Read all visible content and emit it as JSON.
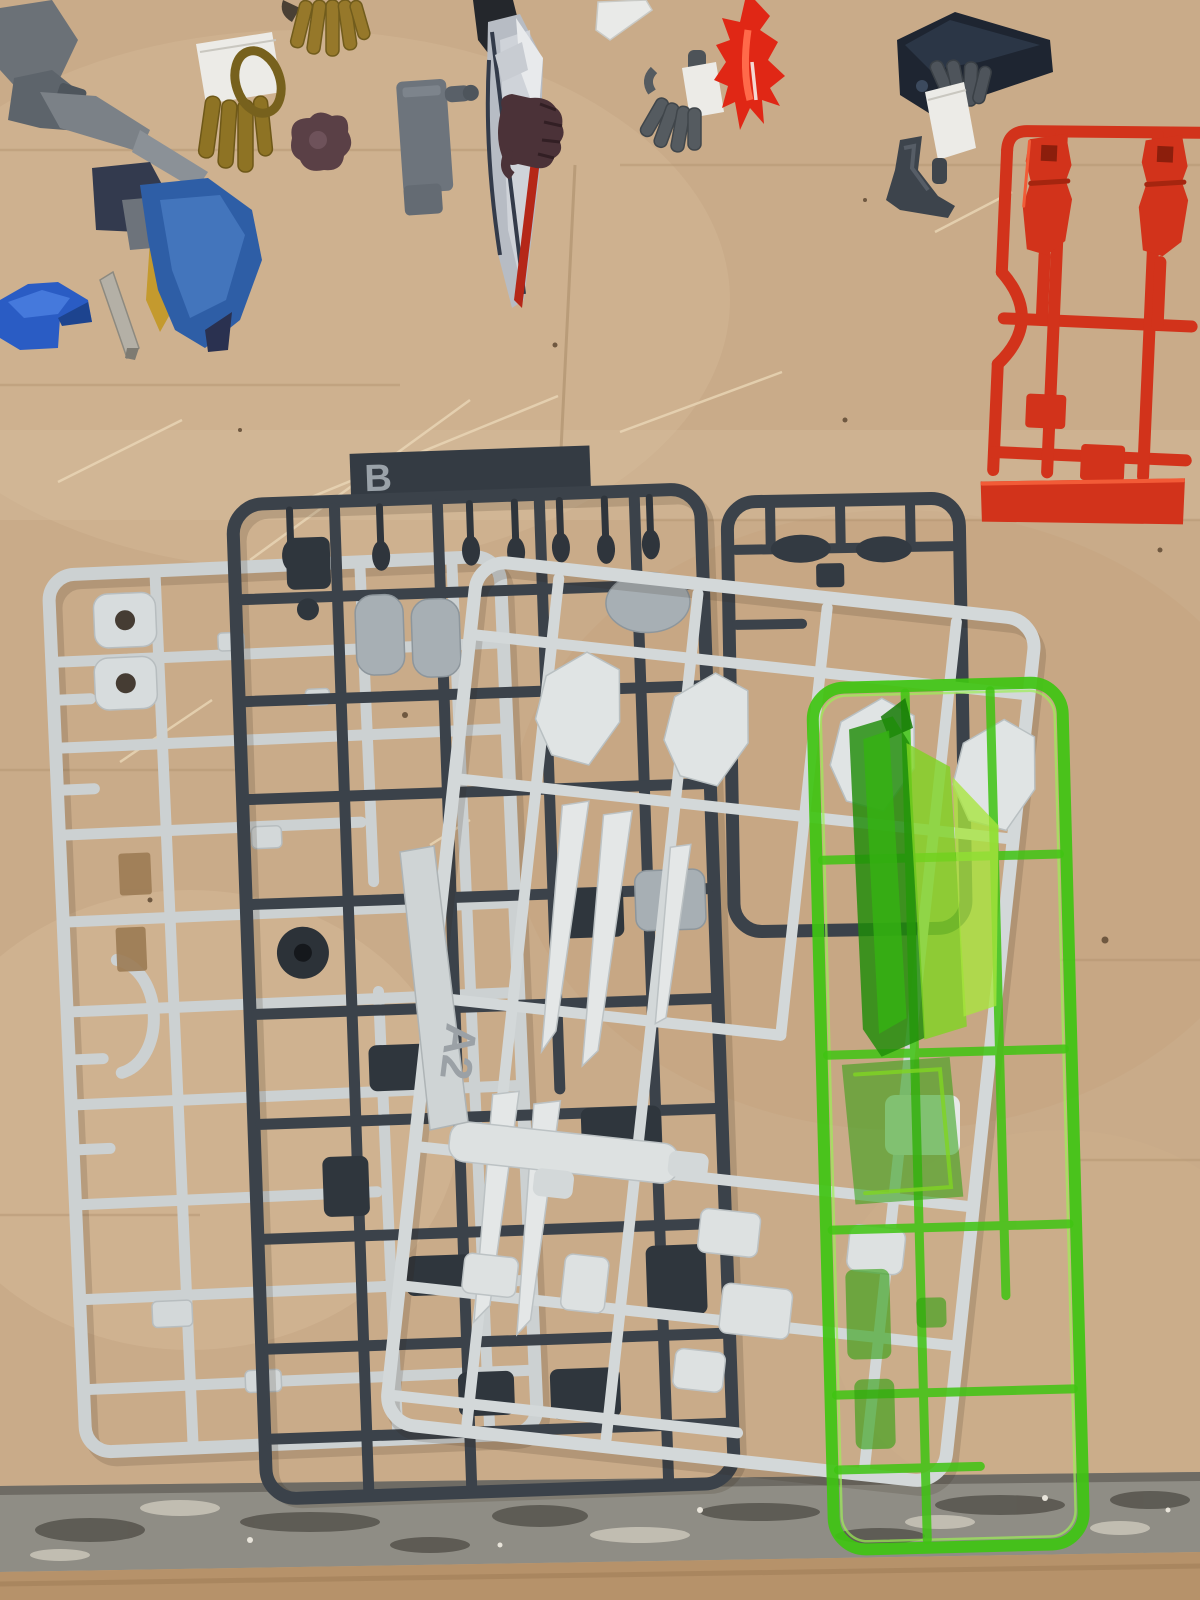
{
  "scene": {
    "description": "Top-down photo of unassembled plastic model-kit (gunpla) runner sprues and loose snipped parts laid out on a light wooden workbench with a worn gray front edge",
    "surface": "light wood desk with scratches, worn metal-gray front edge strip, darker wood below the edge",
    "labels": {
      "sprue_b": "B",
      "sprue_a2": "A2"
    },
    "sprues": [
      {
        "name": "white-left-sprue",
        "label": "",
        "color": "#ccd1d2",
        "description": "light gray runner with round socket knobs, punched-out rectangular gaps and a C-shaped cutout"
      },
      {
        "name": "dark-sprue-b",
        "label": "B",
        "color": "#3b424a",
        "tag_color": "#343b43",
        "description": "dark slate runner with embossed letter tag B, joint pins and frame parts"
      },
      {
        "name": "dark-sprue-small",
        "label": "",
        "color": "#3b424a",
        "description": "second smaller dark slate runner with barrel joint parts"
      },
      {
        "name": "light-sprue-a2",
        "label": "A2",
        "color": "#d3d8d9",
        "description": "large light gray runner lying on top, with shield plates, long fin blades and a barrel part"
      },
      {
        "name": "green-clear-sprue",
        "label": "",
        "color": "#3fc412",
        "description": "transparent neon-green runner with large beam-blade effect parts"
      },
      {
        "name": "red-sprue",
        "label": "",
        "color": "#d2331b",
        "description": "red runner top-right with two foot parts and a solid molded bar"
      }
    ],
    "loose_parts": [
      {
        "name": "gray-mech-corner-parts",
        "color": "#6b7177"
      },
      {
        "name": "taped-gold-hand",
        "color": "#8e7324"
      },
      {
        "name": "gold-finger-parts",
        "color": "#96782a"
      },
      {
        "name": "maroon-joint-part",
        "color": "#5a4046"
      },
      {
        "name": "gray-plate-with-peg",
        "color": "#6d747c"
      },
      {
        "name": "beam-saber-sword",
        "color": "#b7bcc4",
        "edge_color": "#b52718"
      },
      {
        "name": "brown-holding-hand",
        "color": "#4b3238"
      },
      {
        "name": "white-stick-part",
        "color": "#e9eae8"
      },
      {
        "name": "taped-gray-hand-left",
        "color": "#555b60"
      },
      {
        "name": "red-flame-effect",
        "color": "#e02715"
      },
      {
        "name": "navy-wedge-part",
        "color": "#1e2531"
      },
      {
        "name": "taped-gray-hand-right",
        "color": "#4e545b"
      },
      {
        "name": "dark-display-bracket",
        "color": "#3d444c"
      },
      {
        "name": "blue-back-unit",
        "color": "#2e5ea6",
        "trim": "#c49a2e"
      },
      {
        "name": "bright-blue-part",
        "color": "#2a5cc4"
      },
      {
        "name": "thin-gray-rod",
        "color": "#b4b0a6"
      }
    ],
    "colors": {
      "wood": "#c9ab89",
      "wood_light": "#d6bb98",
      "wood_dark": "#b89a78",
      "wood_below_edge": "#b6926a",
      "edge_band": "#8f8d85",
      "edge_dark": "#56534c",
      "edge_light": "#c6c2b6",
      "white_sprue": "#ccd1d2",
      "light_sprue": "#d3d8d9",
      "dark_sprue": "#3b424a",
      "dark_tag": "#343b43",
      "green_sprue": "#3fc412",
      "green_blade_dark": "#1f8c08",
      "green_lime": "#8cdc28",
      "red_sprue": "#d2331b",
      "blade_silver": "#b7bcc4",
      "flame_red": "#e02715",
      "tape_white": "#ecebe7"
    }
  }
}
